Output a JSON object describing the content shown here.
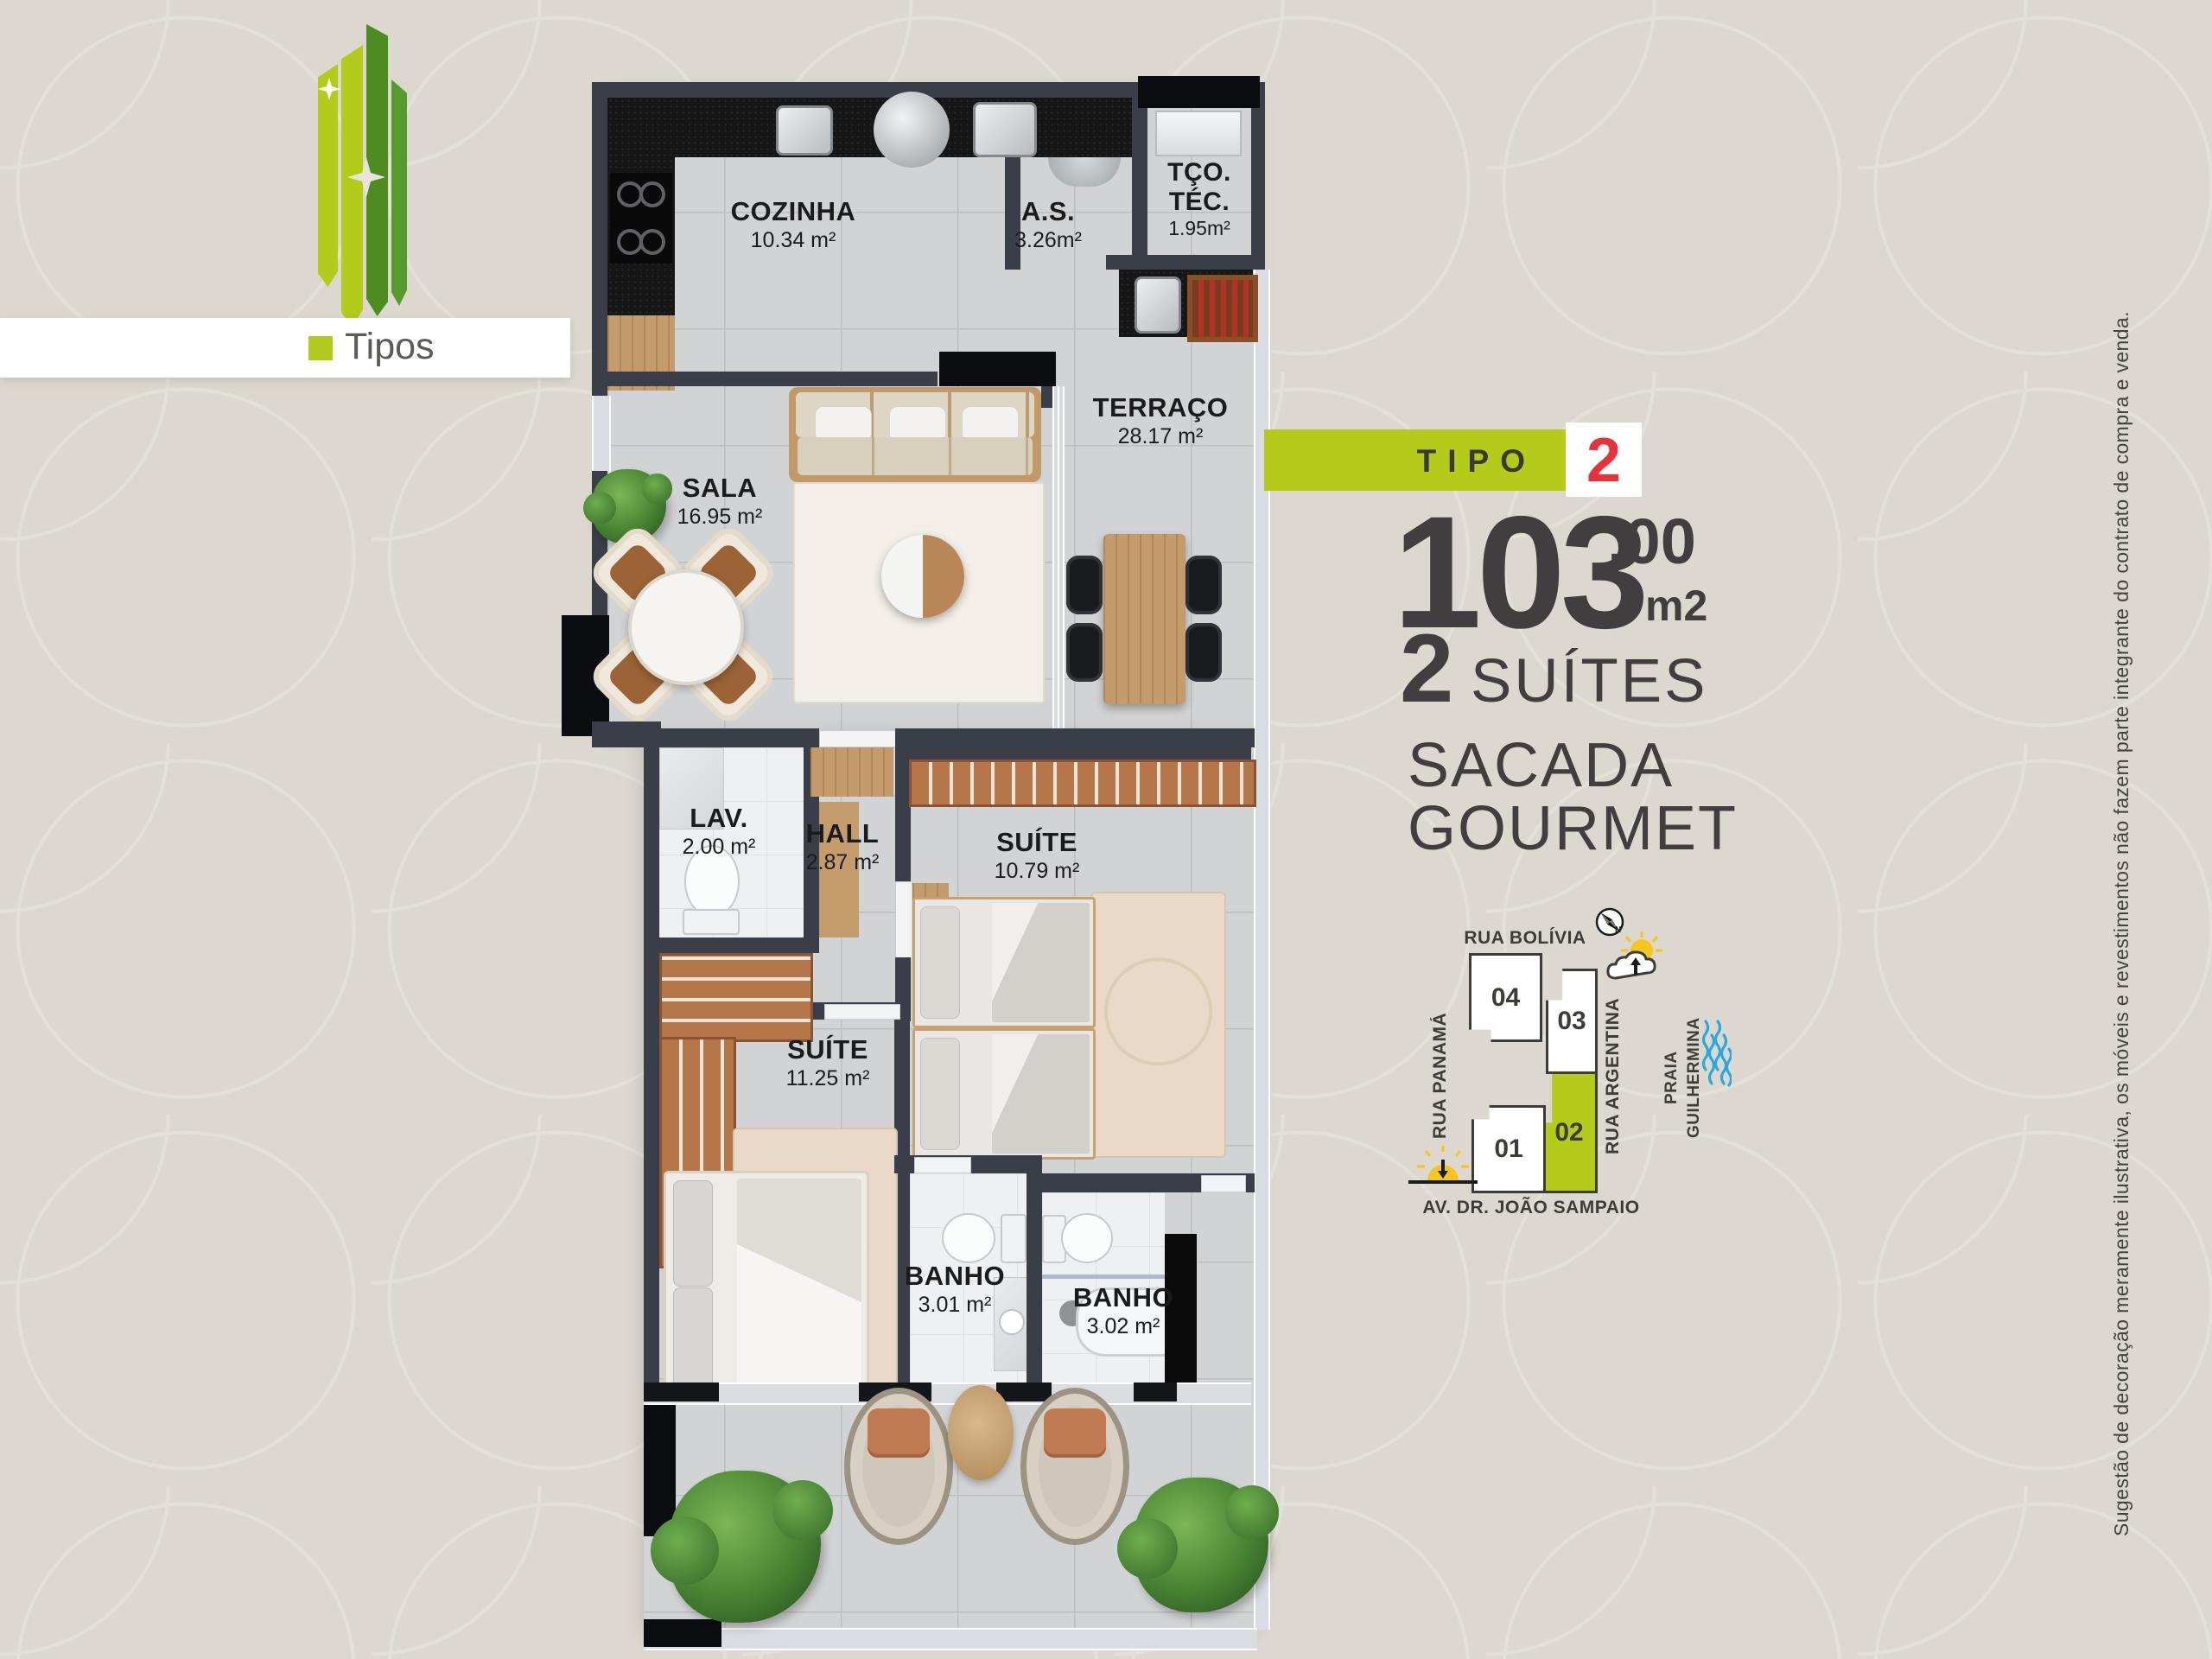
{
  "logo": {
    "label": "Tipos"
  },
  "panel": {
    "tipo_label": "TIPO",
    "tipo_number": "2",
    "area_value": "103",
    "area_decimal": ",00",
    "area_unit": "m2",
    "suites_count": "2",
    "suites_label": "SUÍTES",
    "feature_line1": "SACADA",
    "feature_line2": "GOURMET"
  },
  "floor_plan": {
    "rooms": {
      "cozinha": {
        "name": "COZINHA",
        "area": "10.34 m²"
      },
      "area_servico": {
        "name": "A.S.",
        "area": "3.26m²"
      },
      "terraco_tecnico": {
        "name_line1": "TÇO.",
        "name_line2": "TÉC.",
        "area": "1.95m²"
      },
      "terraco": {
        "name": "TERRAÇO",
        "area": "28.17 m²"
      },
      "sala": {
        "name": "SALA",
        "area": "16.95 m²"
      },
      "lavabo": {
        "name": "LAV.",
        "area": "2.00 m²"
      },
      "hall": {
        "name": "HALL",
        "area": "2.87 m²"
      },
      "suite_1": {
        "name": "SUÍTE",
        "area": "10.79 m²"
      },
      "suite_2": {
        "name": "SUÍTE",
        "area": "11.25 m²"
      },
      "banho_1": {
        "name": "BANHO",
        "area": "3.01 m²"
      },
      "banho_2": {
        "name": "BANHO",
        "area": "3.02 m²"
      }
    }
  },
  "site_map": {
    "street_top": "RUA BOLÍVIA",
    "street_left": "RUA PANAMÁ",
    "street_right": "RUA ARGENTINA",
    "beach": "PRAIA\nGUILHERMINA",
    "avenue": "AV. DR. JOÃO SAMPAIO",
    "compass_label": "N",
    "units": [
      {
        "number": "04",
        "highlighted": false
      },
      {
        "number": "03",
        "highlighted": false
      },
      {
        "number": "02",
        "highlighted": true
      },
      {
        "number": "01",
        "highlighted": false
      }
    ]
  },
  "disclaimer": "Sugestão de decoração meramente ilustrativa, os móveis e revestimentos não fazem parte integrante do contrato de compra e venda.",
  "colors": {
    "background": "#dcd8cf",
    "accent_green": "#b5cb1b",
    "logo_dark_green": "#4e8c22",
    "badge_red": "#e6323a",
    "text_dark": "#423e3f",
    "wall": "#3a3e49",
    "waves_blue": "#2aa9de",
    "sun_yellow": "#f6c51f"
  }
}
